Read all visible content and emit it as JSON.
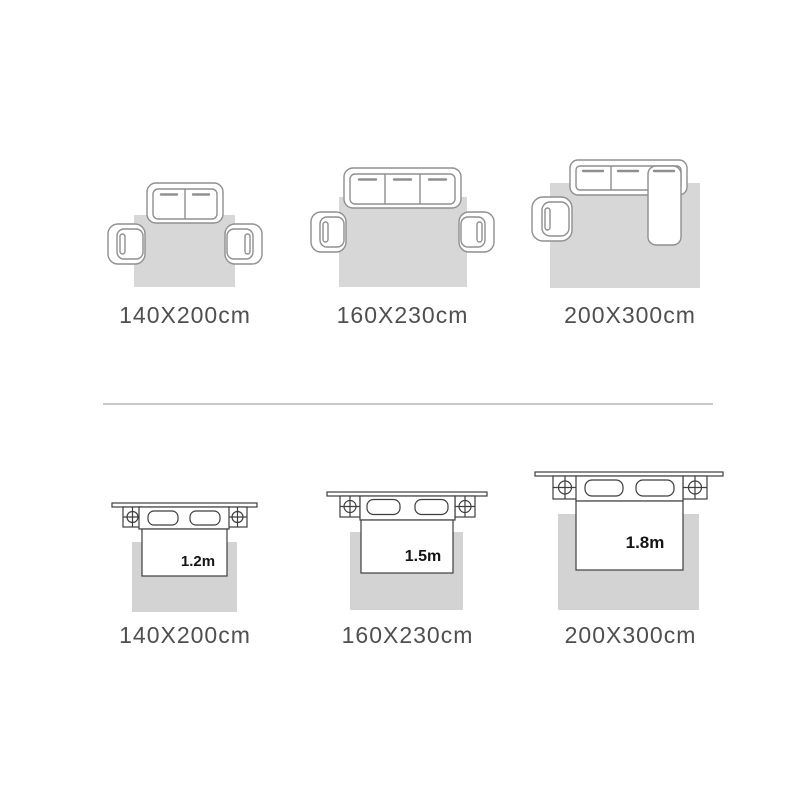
{
  "canvas": {
    "width": 800,
    "height": 800,
    "background": "#ffffff"
  },
  "colors": {
    "rug_fill_sofa": "#d7d7d7",
    "rug_fill_bed": "#d3d3d3",
    "sofa_line": "#8f8f8f",
    "bed_line": "#3e3e3e",
    "label_text": "#4f4f4f",
    "bed_text": "#151515",
    "divider": "#c9c9c9"
  },
  "sofa_row": {
    "items": [
      {
        "illustration": "two-seat-sofa-with-two-armchairs-on-rug",
        "size_label": "140X200cm"
      },
      {
        "illustration": "three-seat-sofa-with-two-armchairs-on-rug",
        "size_label": "160X230cm"
      },
      {
        "illustration": "sectional-sofa-with-chaise-and-one-armchair-on-rug",
        "size_label": "200X300cm"
      }
    ]
  },
  "bed_row": {
    "items": [
      {
        "illustration": "bed-with-two-nightstands-on-rug",
        "bed_size": "1.2m",
        "size_label": "140X200cm"
      },
      {
        "illustration": "bed-with-two-nightstands-on-rug",
        "bed_size": "1.5m",
        "size_label": "160X230cm"
      },
      {
        "illustration": "bed-with-two-nightstands-on-rug",
        "bed_size": "1.8m",
        "size_label": "200X300cm"
      }
    ]
  }
}
